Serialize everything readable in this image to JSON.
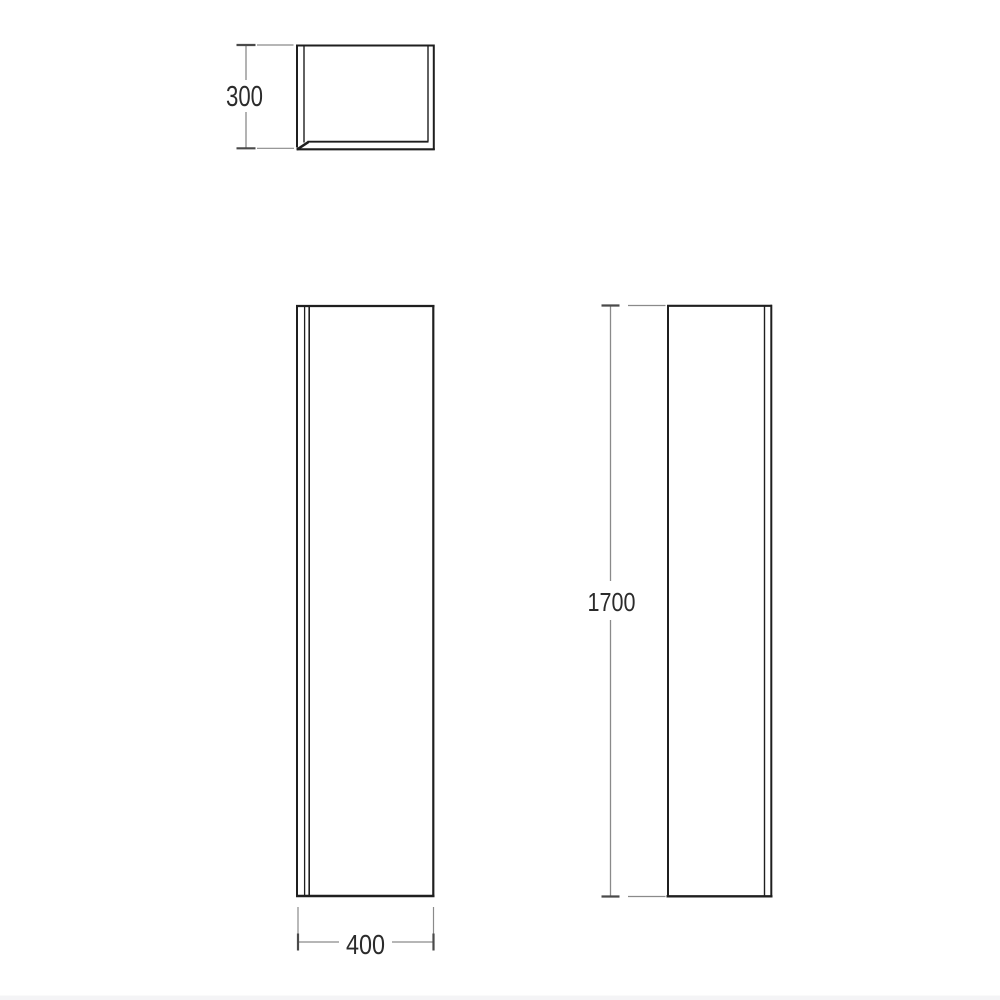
{
  "drawing": {
    "title": "cabinet-dimension-drawing",
    "subject": "tall column cabinet technical drawing with three orthographic views",
    "colors": {
      "background": "#ffffff",
      "outline": "#1f1f1f",
      "dim_line": "#8a8a8a",
      "tick": "#4a4a4a",
      "text": "#2b2b2b",
      "bottom_band": "#f4f4f6"
    },
    "dimensions": {
      "depth": {
        "label": "300",
        "view": "top-view",
        "orientation": "vertical"
      },
      "width": {
        "label": "400",
        "view": "front-view",
        "orientation": "horizontal"
      },
      "height": {
        "label": "1700",
        "view": "side-view",
        "orientation": "vertical"
      }
    },
    "views": {
      "top": {
        "name": "plan view"
      },
      "front": {
        "name": "front elevation"
      },
      "side": {
        "name": "side elevation"
      }
    }
  }
}
